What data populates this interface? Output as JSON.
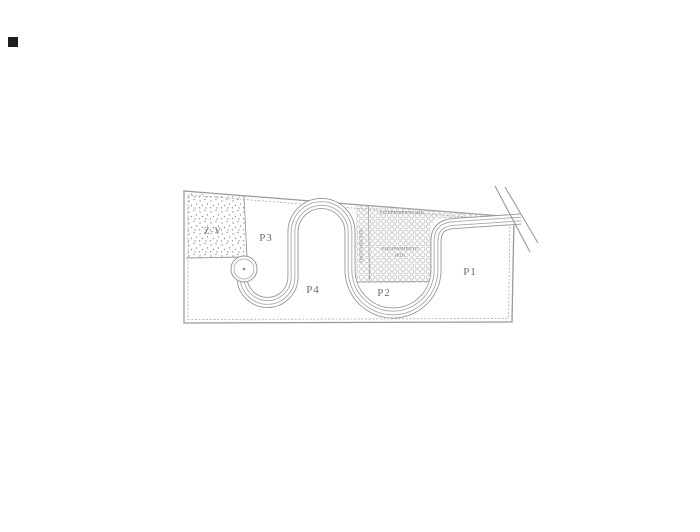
{
  "page": {
    "background": "#ffffff",
    "artifact": "scan-mark"
  },
  "plan": {
    "type": "site-parcelation-plan",
    "parcels": [
      {
        "id": "zv",
        "label": "Z-V"
      },
      {
        "id": "p3",
        "label": "P3"
      },
      {
        "id": "p4",
        "label": "P4"
      },
      {
        "id": "p2",
        "label": "P2"
      },
      {
        "id": "p1",
        "label": "P1"
      }
    ],
    "equipment": {
      "top": "EQUIPAMIENTO (ED)",
      "middle_line1": "EQUIPAMIENTO",
      "middle_line2": "(ED)",
      "vertical": "EQUIPAMIENTO"
    },
    "colors": {
      "line": "#9a9a9a",
      "line_soft": "#a8a8a8",
      "hatch": "#b4b4b4",
      "stipple": "#8f8f8f",
      "text": "#6b6b6b"
    }
  }
}
